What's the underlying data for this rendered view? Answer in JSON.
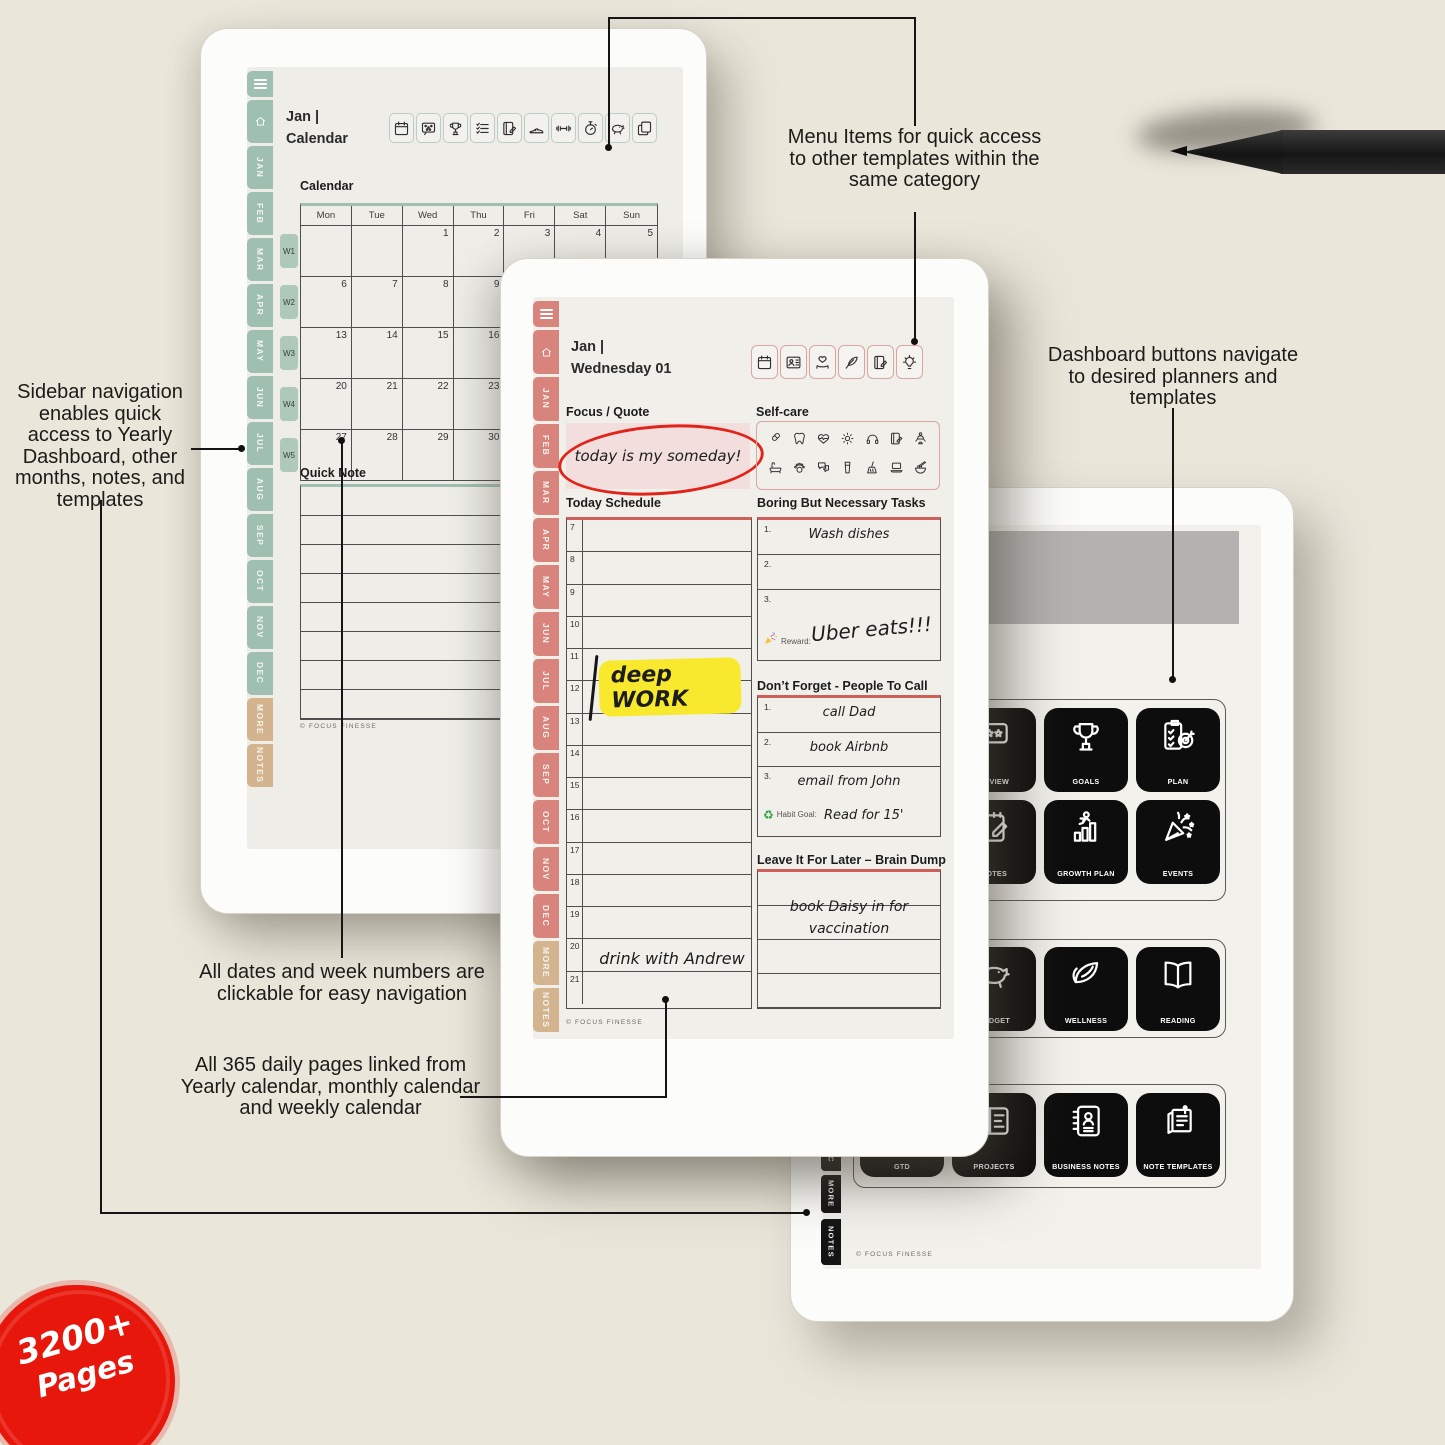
{
  "colors": {
    "sage": "#9fc0b0",
    "sage-light": "#aec9ba",
    "tan": "#d3b48e",
    "salmon": "#d8837b",
    "salmon-border": "#dba69f",
    "red-accent": "#cf5f5a",
    "marker-red": "#e2231a",
    "highlight-yellow": "#f8e92e",
    "badge-red": "#e8170b",
    "button-black": "#0d0d0d",
    "band-gray": "#b3b2b0"
  },
  "badge": {
    "line1": "3200+",
    "line2": "Pages"
  },
  "annotations": {
    "menu_items": "Menu Items for quick access to other templates within the same category",
    "sidebar_nav": "Sidebar navigation enables quick access to Yearly Dashboard, other months, notes, and templates",
    "dashboard_buttons": "Dashboard buttons navigate to desired planners and templates",
    "clickable_dates": "All dates and week numbers are clickable for easy navigation",
    "daily_pages": "All 365 daily pages linked from Yearly calendar, monthly calendar and weekly calendar"
  },
  "shared": {
    "months": [
      "JAN",
      "FEB",
      "MAR",
      "APR",
      "MAY",
      "JUN",
      "JUL",
      "AUG",
      "SEP",
      "OCT",
      "NOV",
      "DEC"
    ],
    "extra_tabs": [
      "MORE",
      "NOTES"
    ],
    "footer": "© FOCUS FINESSE"
  },
  "left_tablet": {
    "title_line1": "Jan |",
    "title_line2": "Calendar",
    "menu_icons": [
      "calendar-icon",
      "habit-tracker-icon",
      "trophy-icon",
      "checklist-icon",
      "journal-icon",
      "sneaker-icon",
      "dumbbell-icon",
      "timer-icon",
      "piggy-bank-icon",
      "templates-icon"
    ],
    "calendar": {
      "label": "Calendar",
      "day_headers": [
        "Mon",
        "Tue",
        "Wed",
        "Thu",
        "Fri",
        "Sat",
        "Sun"
      ],
      "weeks": [
        {
          "label": "W1",
          "dates": [
            "",
            "",
            "1",
            "2",
            "3",
            "4",
            "5"
          ]
        },
        {
          "label": "W2",
          "dates": [
            "6",
            "7",
            "8",
            "9",
            "10",
            "11",
            "12"
          ]
        },
        {
          "label": "W3",
          "dates": [
            "13",
            "14",
            "15",
            "16",
            "17",
            "18",
            "19"
          ]
        },
        {
          "label": "W4",
          "dates": [
            "20",
            "21",
            "22",
            "23",
            "24",
            "25",
            "26"
          ]
        },
        {
          "label": "W5",
          "dates": [
            "27",
            "28",
            "29",
            "30",
            "31",
            "",
            ""
          ]
        }
      ]
    },
    "quick_note_label": "Quick Note"
  },
  "middle_tablet": {
    "title_line1": "Jan |",
    "title_line2": "Wednesday 01",
    "menu_icons": [
      "calendar-icon",
      "contacts-icon",
      "heart-hand-icon",
      "feather-icon",
      "journal-icon",
      "idea-bulb-icon"
    ],
    "focus": {
      "label": "Focus / Quote",
      "handwriting": "today is my someday!"
    },
    "selfcare": {
      "label": "Self-care",
      "icons": [
        "capsule-icon",
        "tooth-icon",
        "heart-pulse-icon",
        "sun-icon",
        "headphones-icon",
        "journal-icon",
        "meditation-icon",
        "bathtub-icon",
        "paw-icon",
        "chat-icon",
        "water-glass-icon",
        "broom-icon",
        "laptop-icon",
        "noodles-icon"
      ]
    },
    "schedule": {
      "label": "Today Schedule",
      "hours": [
        "7",
        "8",
        "9",
        "10",
        "11",
        "12",
        "13",
        "14",
        "15",
        "16",
        "17",
        "18",
        "19",
        "20",
        "21"
      ],
      "deep_work": "deep WORK",
      "evening_entry": "drink with Andrew"
    },
    "tasks": {
      "label": "Boring But Necessary Tasks",
      "nums": [
        "1.",
        "2.",
        "3."
      ],
      "rows": [
        "Wash dishes",
        "",
        ""
      ],
      "reward_label": "Reward:",
      "reward_text": "Uber eats!!!"
    },
    "calls": {
      "label": "Don’t Forget - People To Call",
      "nums": [
        "1.",
        "2.",
        "3."
      ],
      "rows": [
        "call Dad",
        "book Airbnb",
        "email from John"
      ],
      "habit_icon": "♻",
      "habit_label": "Habit Goal:",
      "habit_text": "Read for 15'"
    },
    "braindump": {
      "label": "Leave It For Later – Brain Dump",
      "line1": "book Daisy in for",
      "line2": "vaccination"
    }
  },
  "right_tablet": {
    "sidebar_tabs": [
      "C",
      "MORE",
      "NOTES"
    ],
    "dashboard_groups": [
      {
        "buttons": [
          {
            "label": "REVIEW",
            "icon": "review-icon",
            "col": 1,
            "row": 0
          },
          {
            "label": "GOALS",
            "icon": "trophy-icon",
            "col": 2,
            "row": 0
          },
          {
            "label": "PLAN",
            "icon": "plan-icon",
            "col": 3,
            "row": 0
          },
          {
            "label": "NOTES",
            "icon": "notes-icon",
            "col": 1,
            "row": 1
          },
          {
            "label": "GROWTH PLAN",
            "icon": "growth-icon",
            "col": 2,
            "row": 1
          },
          {
            "label": "EVENTS",
            "icon": "events-icon",
            "col": 3,
            "row": 1
          }
        ]
      },
      {
        "buttons": [
          {
            "label": "BUDGET",
            "icon": "piggy-bank-icon",
            "col": 1,
            "row": 0
          },
          {
            "label": "WELLNESS",
            "icon": "wellness-icon",
            "col": 2,
            "row": 0
          },
          {
            "label": "READING",
            "icon": "reading-icon",
            "col": 3,
            "row": 0
          }
        ]
      },
      {
        "buttons": [
          {
            "label": "GTD",
            "icon": "gtd-icon",
            "col": 0,
            "row": 0
          },
          {
            "label": "PROJECTS",
            "icon": "projects-icon",
            "col": 1,
            "row": 0
          },
          {
            "label": "BUSINESS NOTES",
            "icon": "business-notes-icon",
            "col": 2,
            "row": 0
          },
          {
            "label": "NOTE TEMPLATES",
            "icon": "note-templates-icon",
            "col": 3,
            "row": 0
          }
        ]
      }
    ]
  }
}
